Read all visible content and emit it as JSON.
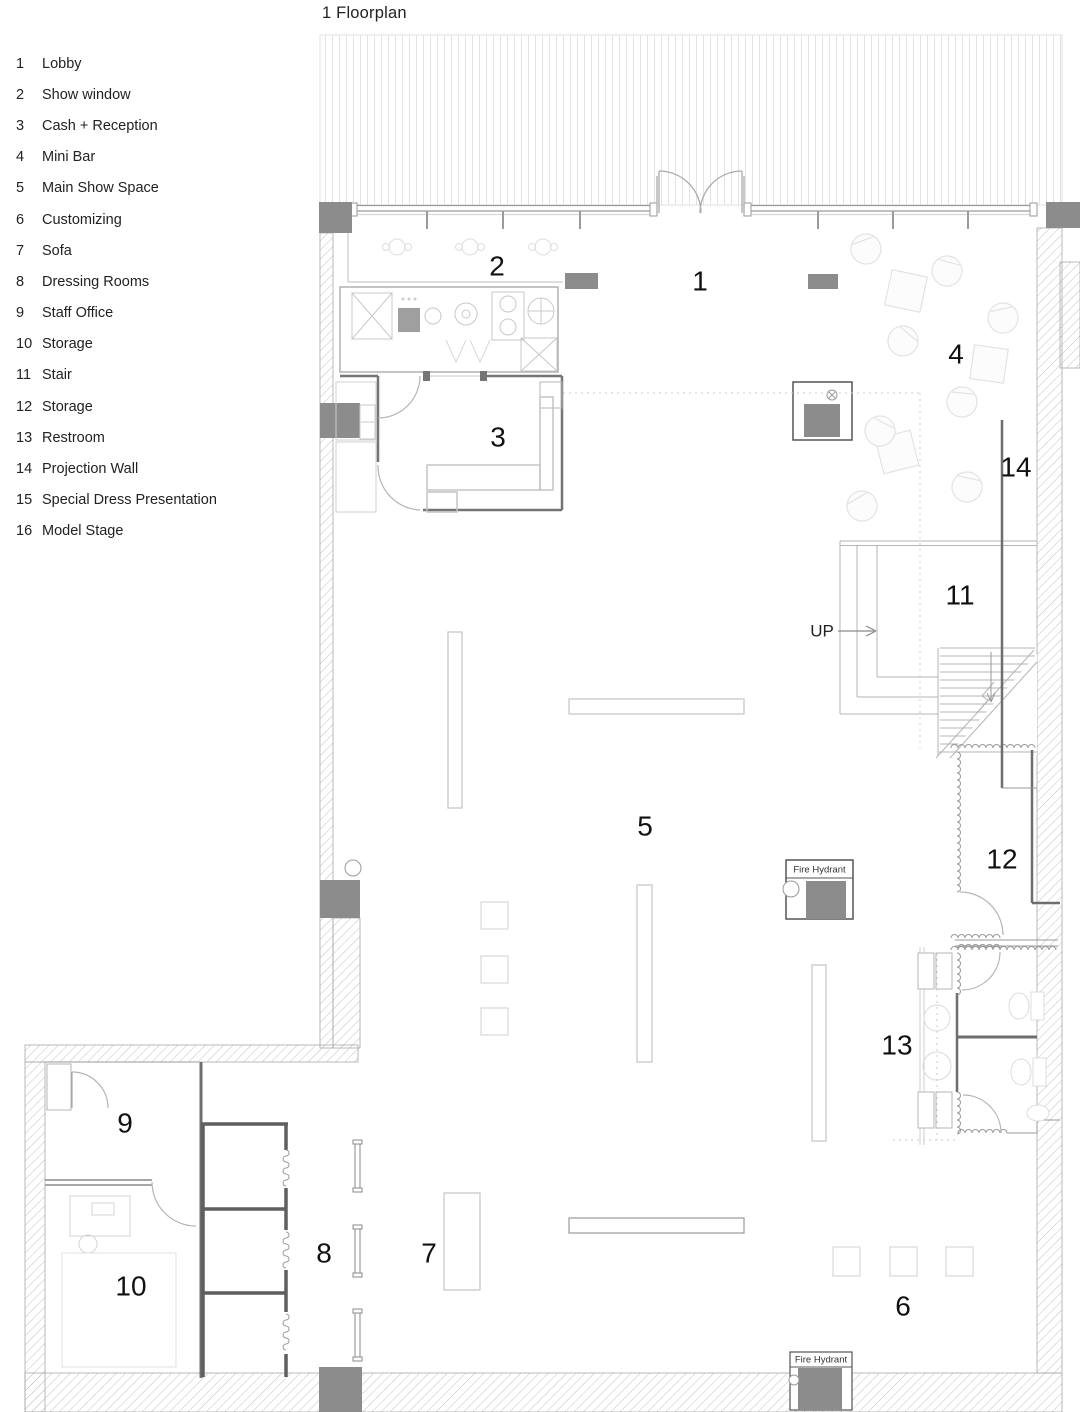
{
  "title": "1 Floorplan",
  "legend": {
    "items": [
      {
        "number": "1",
        "label": "Lobby"
      },
      {
        "number": "2",
        "label": "Show window"
      },
      {
        "number": "3",
        "label": "Cash + Reception"
      },
      {
        "number": "4",
        "label": "Mini Bar"
      },
      {
        "number": "5",
        "label": "Main Show Space"
      },
      {
        "number": "6",
        "label": "Customizing"
      },
      {
        "number": "7",
        "label": "Sofa"
      },
      {
        "number": "8",
        "label": "Dressing Rooms"
      },
      {
        "number": "9",
        "label": "Staff Office"
      },
      {
        "number": "10",
        "label": "Storage"
      },
      {
        "number": "11",
        "label": "Stair"
      },
      {
        "number": "12",
        "label": "Storage"
      },
      {
        "number": "13",
        "label": "Restroom"
      },
      {
        "number": "14",
        "label": "Projection Wall"
      },
      {
        "number": "15",
        "label": "Special Dress Presentation"
      },
      {
        "number": "16",
        "label": "Model Stage"
      }
    ]
  },
  "plan": {
    "room_labels": {
      "r1": "1",
      "r2": "2",
      "r3": "3",
      "r4": "4",
      "r5": "5",
      "r6": "6",
      "r7": "7",
      "r8": "8",
      "r9": "9",
      "r10": "10",
      "r11": "11",
      "r12": "12",
      "r13": "13",
      "r14": "14"
    },
    "up_label": "UP",
    "fire_hydrant_label": "Fire Hydrant",
    "colors": {
      "column_fill": "#8c8c8c",
      "wall_line": "#6e6e6e",
      "hatch_line": "#c2c2c2",
      "fixture_line": "#c8c8c8",
      "text": "#111111"
    }
  }
}
